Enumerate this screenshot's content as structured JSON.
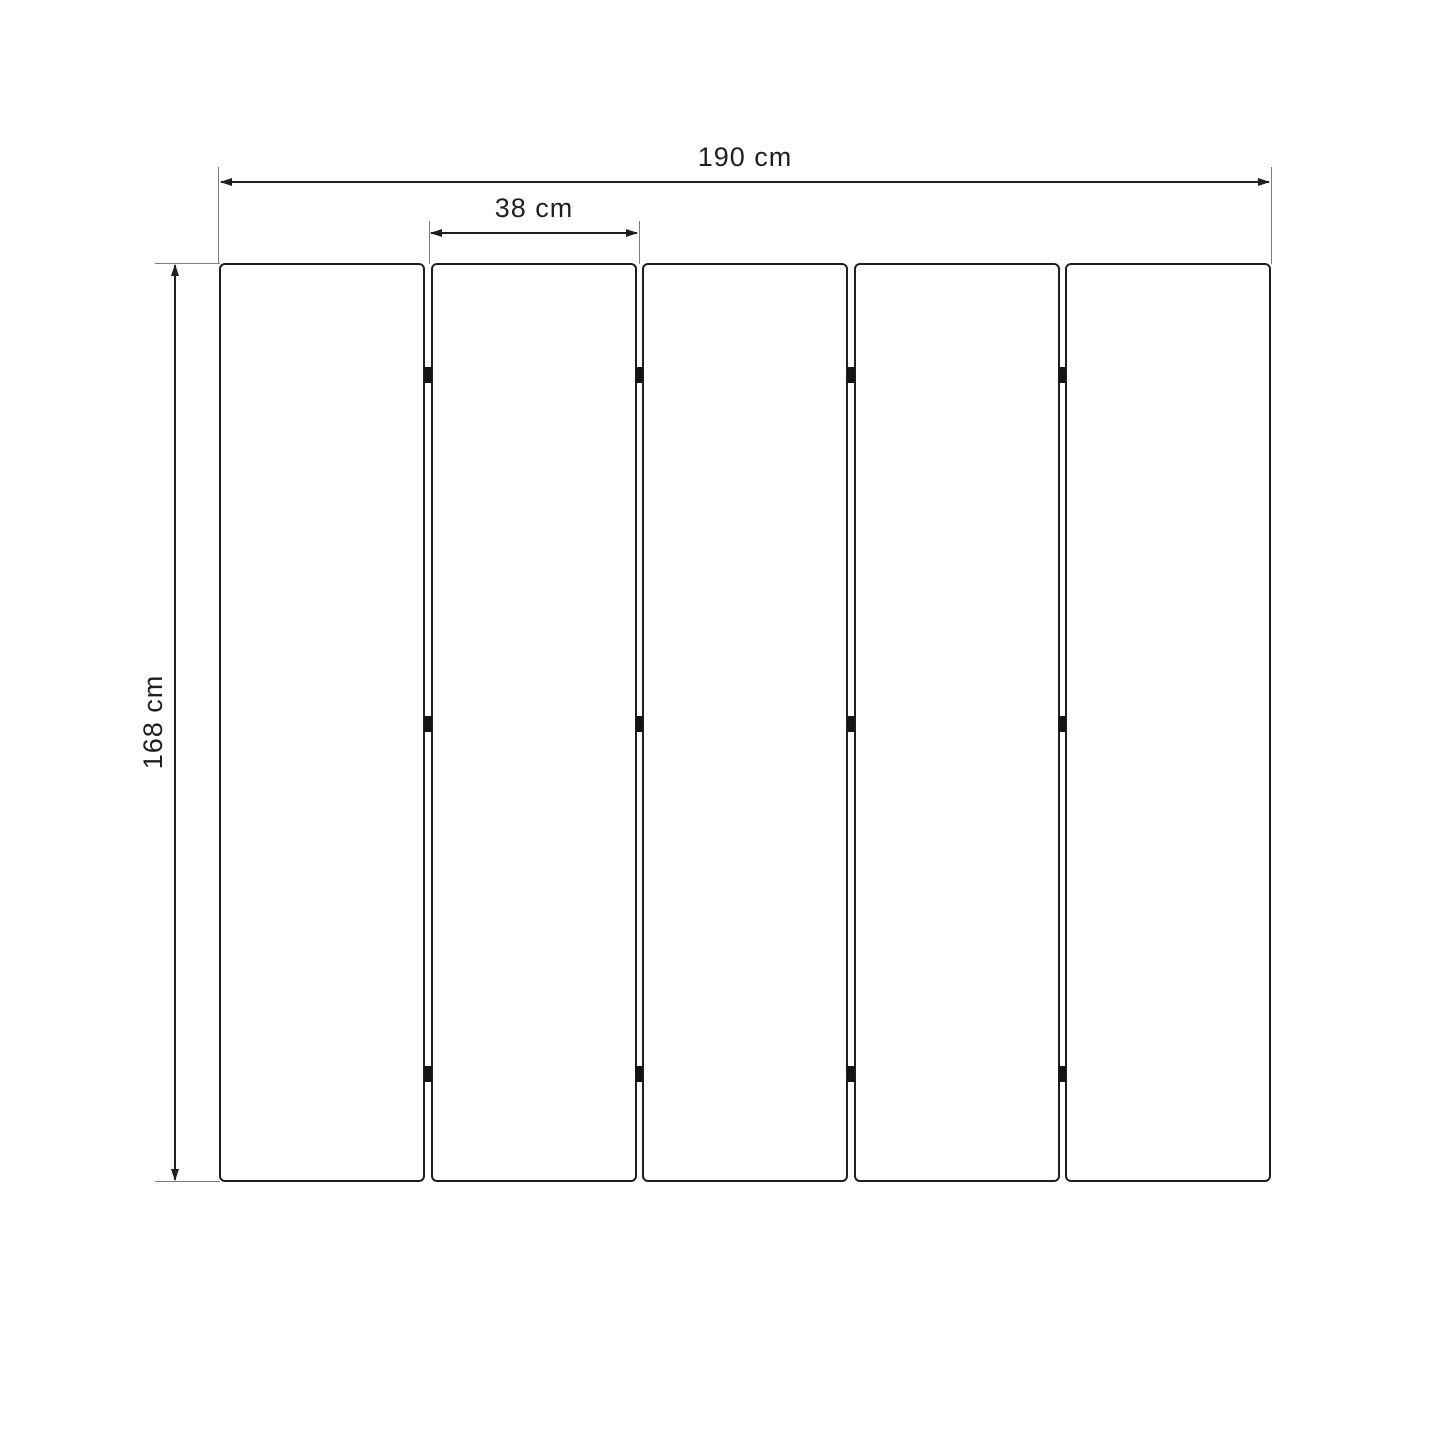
{
  "diagram": {
    "kind": "folding-screen dimension drawing",
    "panel_count": 5,
    "hinge_gaps": 4,
    "hinges_per_gap": 3,
    "labels": {
      "total_width": "190 cm",
      "panel_width": "38 cm",
      "panel_height": "168 cm"
    },
    "colors": {
      "background": "#ffffff",
      "stroke": "#1f1f1f",
      "extension_line": "#7d7d7d",
      "hinge": "#151515"
    }
  }
}
